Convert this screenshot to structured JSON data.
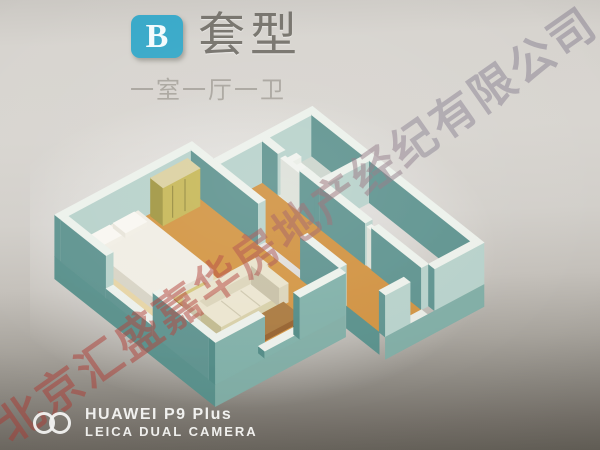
{
  "header": {
    "badge_label": "B",
    "title": "套型",
    "subtitle": "一室一厅一卫"
  },
  "watermark": {
    "text": "北京汇盛嘉华房地产经纪有限公司",
    "color_start": "#b5443c",
    "color_end": "#8a8292"
  },
  "camera_overlay": {
    "brand_line": "HUAWEI P9 Plus",
    "camera_line": "LEICA DUAL CAMERA"
  },
  "colors": {
    "badge_blue": "#36a8c8",
    "title_gray": "#75726b",
    "subtitle_gray": "#a9a59e",
    "wall_teal_light": "#b7d2cb",
    "wall_teal_dark": "#5c928e",
    "floor_orange": "#d39440",
    "paper_top": "#d8d5d0",
    "paper_bottom": "#625e56"
  }
}
